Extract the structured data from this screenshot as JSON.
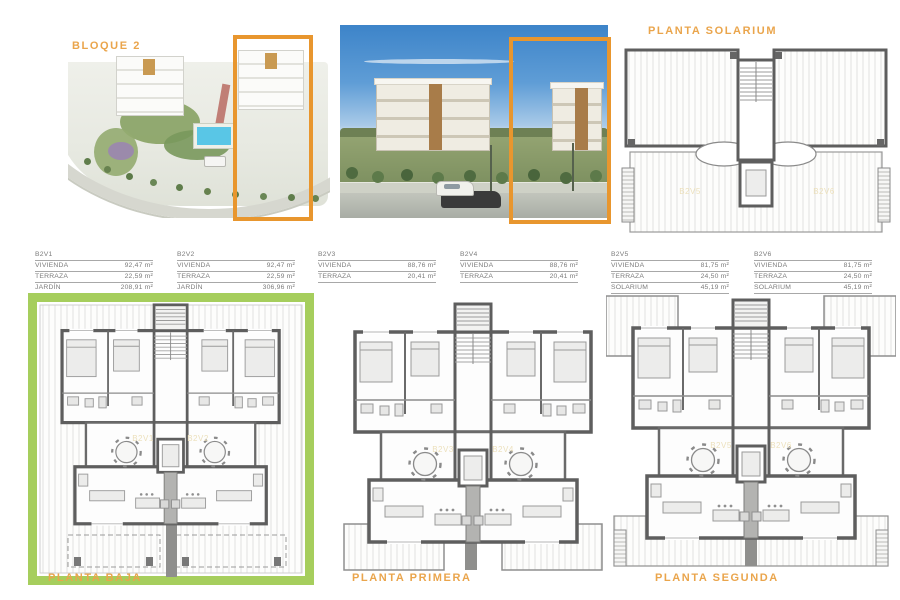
{
  "colors": {
    "accent_orange": "#E8962E",
    "title_orange": "#EAA54C",
    "green_border": "#A6CE5D",
    "plan_wall_gray": "#5E5E5E",
    "table_text_gray": "#787878",
    "pool_blue": "#59C6E6",
    "sky_blue": "#3D84C9"
  },
  "header": {
    "bloque_label": "BLOQUE 2",
    "solarium_title": "PLANTA SOLARIUM"
  },
  "units": [
    {
      "name": "B2V1",
      "rows": [
        {
          "label": "VIVIENDA",
          "value": "92,47 m²"
        },
        {
          "label": "TERRAZA",
          "value": "22,59 m²"
        },
        {
          "label": "JARDÍN",
          "value": "208,91 m²"
        }
      ]
    },
    {
      "name": "B2V2",
      "rows": [
        {
          "label": "VIVIENDA",
          "value": "92,47 m²"
        },
        {
          "label": "TERRAZA",
          "value": "22,59 m²"
        },
        {
          "label": "JARDÍN",
          "value": "306,96 m²"
        }
      ]
    },
    {
      "name": "B2V3",
      "rows": [
        {
          "label": "VIVIENDA",
          "value": "88,76 m²"
        },
        {
          "label": "TERRAZA",
          "value": "20,41 m²"
        }
      ]
    },
    {
      "name": "B2V4",
      "rows": [
        {
          "label": "VIVIENDA",
          "value": "88,76 m²"
        },
        {
          "label": "TERRAZA",
          "value": "20,41 m²"
        }
      ]
    },
    {
      "name": "B2V5",
      "rows": [
        {
          "label": "VIVIENDA",
          "value": "81,75 m²"
        },
        {
          "label": "TERRAZA",
          "value": "24,50 m²"
        },
        {
          "label": "SOLARIUM",
          "value": "45,19 m²"
        }
      ]
    },
    {
      "name": "B2V6",
      "rows": [
        {
          "label": "VIVIENDA",
          "value": "81,75 m²"
        },
        {
          "label": "TERRAZA",
          "value": "24,50 m²"
        },
        {
          "label": "SOLARIUM",
          "value": "45,19 m²"
        }
      ]
    }
  ],
  "plans": {
    "solarium": {
      "title": "PLANTA SOLARIUM",
      "unit_left": "B2V5",
      "unit_right": "B2V6"
    },
    "baja": {
      "title": "PLANTA BAJA",
      "unit_left": "B2V1",
      "unit_right": "B2V2"
    },
    "primera": {
      "title": "PLANTA PRIMERA",
      "unit_left": "B2V3",
      "unit_right": "B2V4"
    },
    "segunda": {
      "title": "PLANTA SEGUNDA",
      "unit_left": "B2V5",
      "unit_right": "B2V6"
    }
  }
}
